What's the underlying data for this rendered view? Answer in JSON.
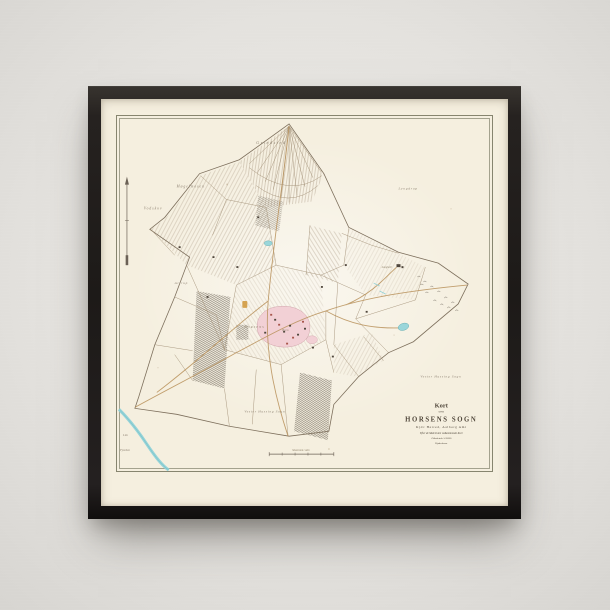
{
  "scene": {
    "wall_color": "#dedcd8",
    "frame_color": "#1e1b19",
    "paper_color": "#f5efdf"
  },
  "map": {
    "title_block": {
      "kort": "Kort",
      "over": "over",
      "title": "HORSENS SOGN",
      "subtitle": "Kjær Herred, Aalborg Amt",
      "note1": "Efter de Matriculen vedkommende Kort",
      "note2": "i Maalestok 1:20000",
      "note3": "Kjøbenhavn"
    },
    "labels": {
      "grindsted": "Grindsted",
      "mogelmosen": "Møgelmosen",
      "vodskov": "Vodskov",
      "attrup": "Attrup",
      "lyngdrup": "Lyngdrup",
      "vester_hassing_east": "Vester Hassing Sogn",
      "vester_hassing_south": "Vester Hassing Sogn",
      "lim": "Lim",
      "fjorden": "Fjorden",
      "langholt": "Langholt",
      "horsens": "HORSENS",
      "byen": "Byen",
      "scale": "Maalestok i Alen"
    },
    "colors": {
      "ink": "#9b8a72",
      "boundary": "#7d6f5c",
      "water": "#8fd2d8",
      "village_pink": "#f2d0d5",
      "farm_orange": "#d09a40",
      "building_red": "#a8564c"
    }
  }
}
